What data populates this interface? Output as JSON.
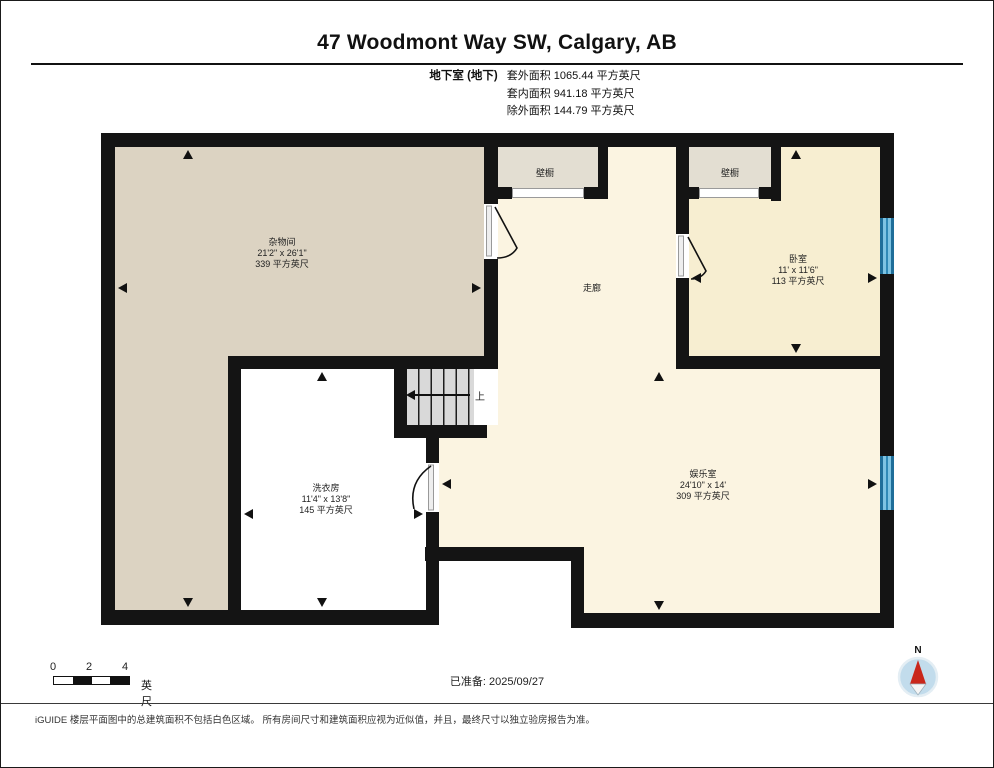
{
  "title": "47 Woodmont Way SW, Calgary, AB",
  "floor_summary": {
    "floor_label": "地下室 (地下)",
    "lines": [
      "套外面积 1065.44 平方英尺",
      "套内面积 941.18 平方英尺",
      "除外面积 144.79 平方英尺"
    ]
  },
  "rooms": {
    "storage": {
      "name": "杂物间",
      "dims": "21'2\" x 26'1\"",
      "area": "339 平方英尺"
    },
    "laundry": {
      "name": "洗衣房",
      "dims": "11'4\" x 13'8\"",
      "area": "145 平方英尺"
    },
    "bedroom": {
      "name": "卧室",
      "dims": "11' x 11'6\"",
      "area": "113 平方英尺"
    },
    "rec": {
      "name": "娱乐室",
      "dims": "24'10\" x 14'",
      "area": "309 平方英尺"
    },
    "corridor": {
      "name": "走廊"
    },
    "closet1": {
      "name": "壁橱"
    },
    "closet2": {
      "name": "壁橱"
    }
  },
  "stairs": {
    "up_label": "上"
  },
  "footer": {
    "scale": {
      "ticks": [
        "0",
        "2",
        "4"
      ],
      "unit": "英尺"
    },
    "prepared": "已准备: 2025/09/27",
    "compass_label": "N",
    "disclaimer": "iGUIDE 楼层平面图中的总建筑面积不包括白色区域。 所有房间尺寸和建筑面积应视为近似值，并且，最终尺寸以独立验房报告为准。"
  },
  "colors": {
    "wall": "#141414",
    "storage_fill": "#DCD3C2",
    "corridor_fill": "#FBF4E1",
    "bedroom_fill": "#F7EED1",
    "closet_fill": "#E3DED2",
    "stairs_fill": "#D9D9D9",
    "window_blue": "#5FB0D8",
    "compass_red": "#C9271B",
    "compass_circle": "#C2DCEC"
  }
}
